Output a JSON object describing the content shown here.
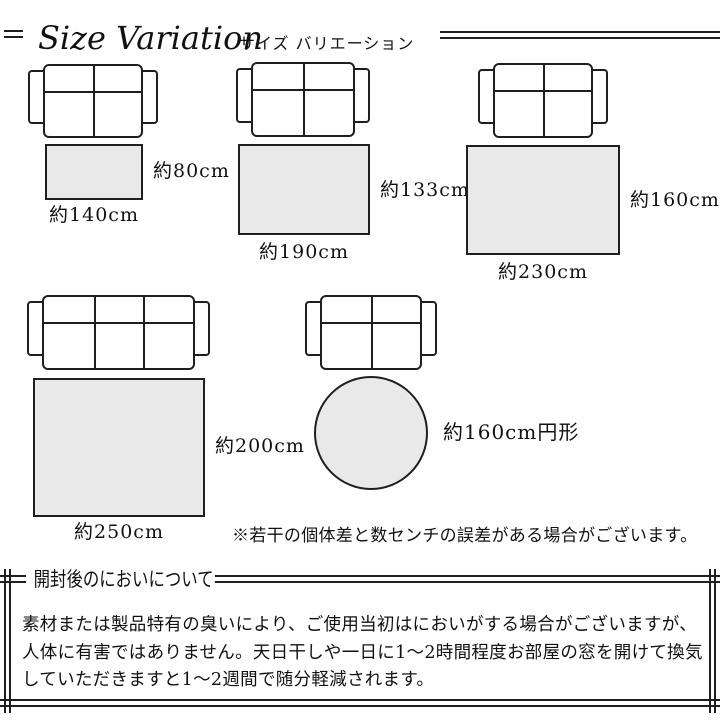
{
  "header": {
    "title": "Size Variation",
    "subtitle": "サイズ バリエーション"
  },
  "size_variation": {
    "diagrams": [
      {
        "name": "140x80",
        "sofa": "2-seater",
        "rug_shape": "rectangle",
        "width_label": "約140cm",
        "depth_label": "約80cm"
      },
      {
        "name": "190x133",
        "sofa": "2-seater",
        "rug_shape": "rectangle",
        "width_label": "約190cm",
        "depth_label": "約133cm"
      },
      {
        "name": "230x160",
        "sofa": "2-seater",
        "rug_shape": "rectangle",
        "width_label": "約230cm",
        "depth_label": "約160cm"
      },
      {
        "name": "250x200",
        "sofa": "3-seater",
        "rug_shape": "rectangle",
        "width_label": "約250cm",
        "depth_label": "約200cm"
      },
      {
        "name": "160-round",
        "sofa": "2-seater",
        "rug_shape": "circle",
        "diameter_label": "約160cm円形"
      }
    ],
    "note": "※若干の個体差と数センチの誤差がある場合がございます。"
  },
  "odor_section": {
    "heading": "開封後のにおいについて",
    "body_lines": [
      "素材または製品特有の臭いにより、ご使用当初はにおいがする場合がございますが、",
      "人体に有害ではありません。天日干しや一日に1〜2時間程度お部屋の窓を開けて換気",
      "していただきますと1〜2週間で随分軽減されます。"
    ]
  },
  "colors": {
    "line": "#1f1f1f",
    "rug_fill": "#e9e9e9",
    "text": "#111111"
  }
}
